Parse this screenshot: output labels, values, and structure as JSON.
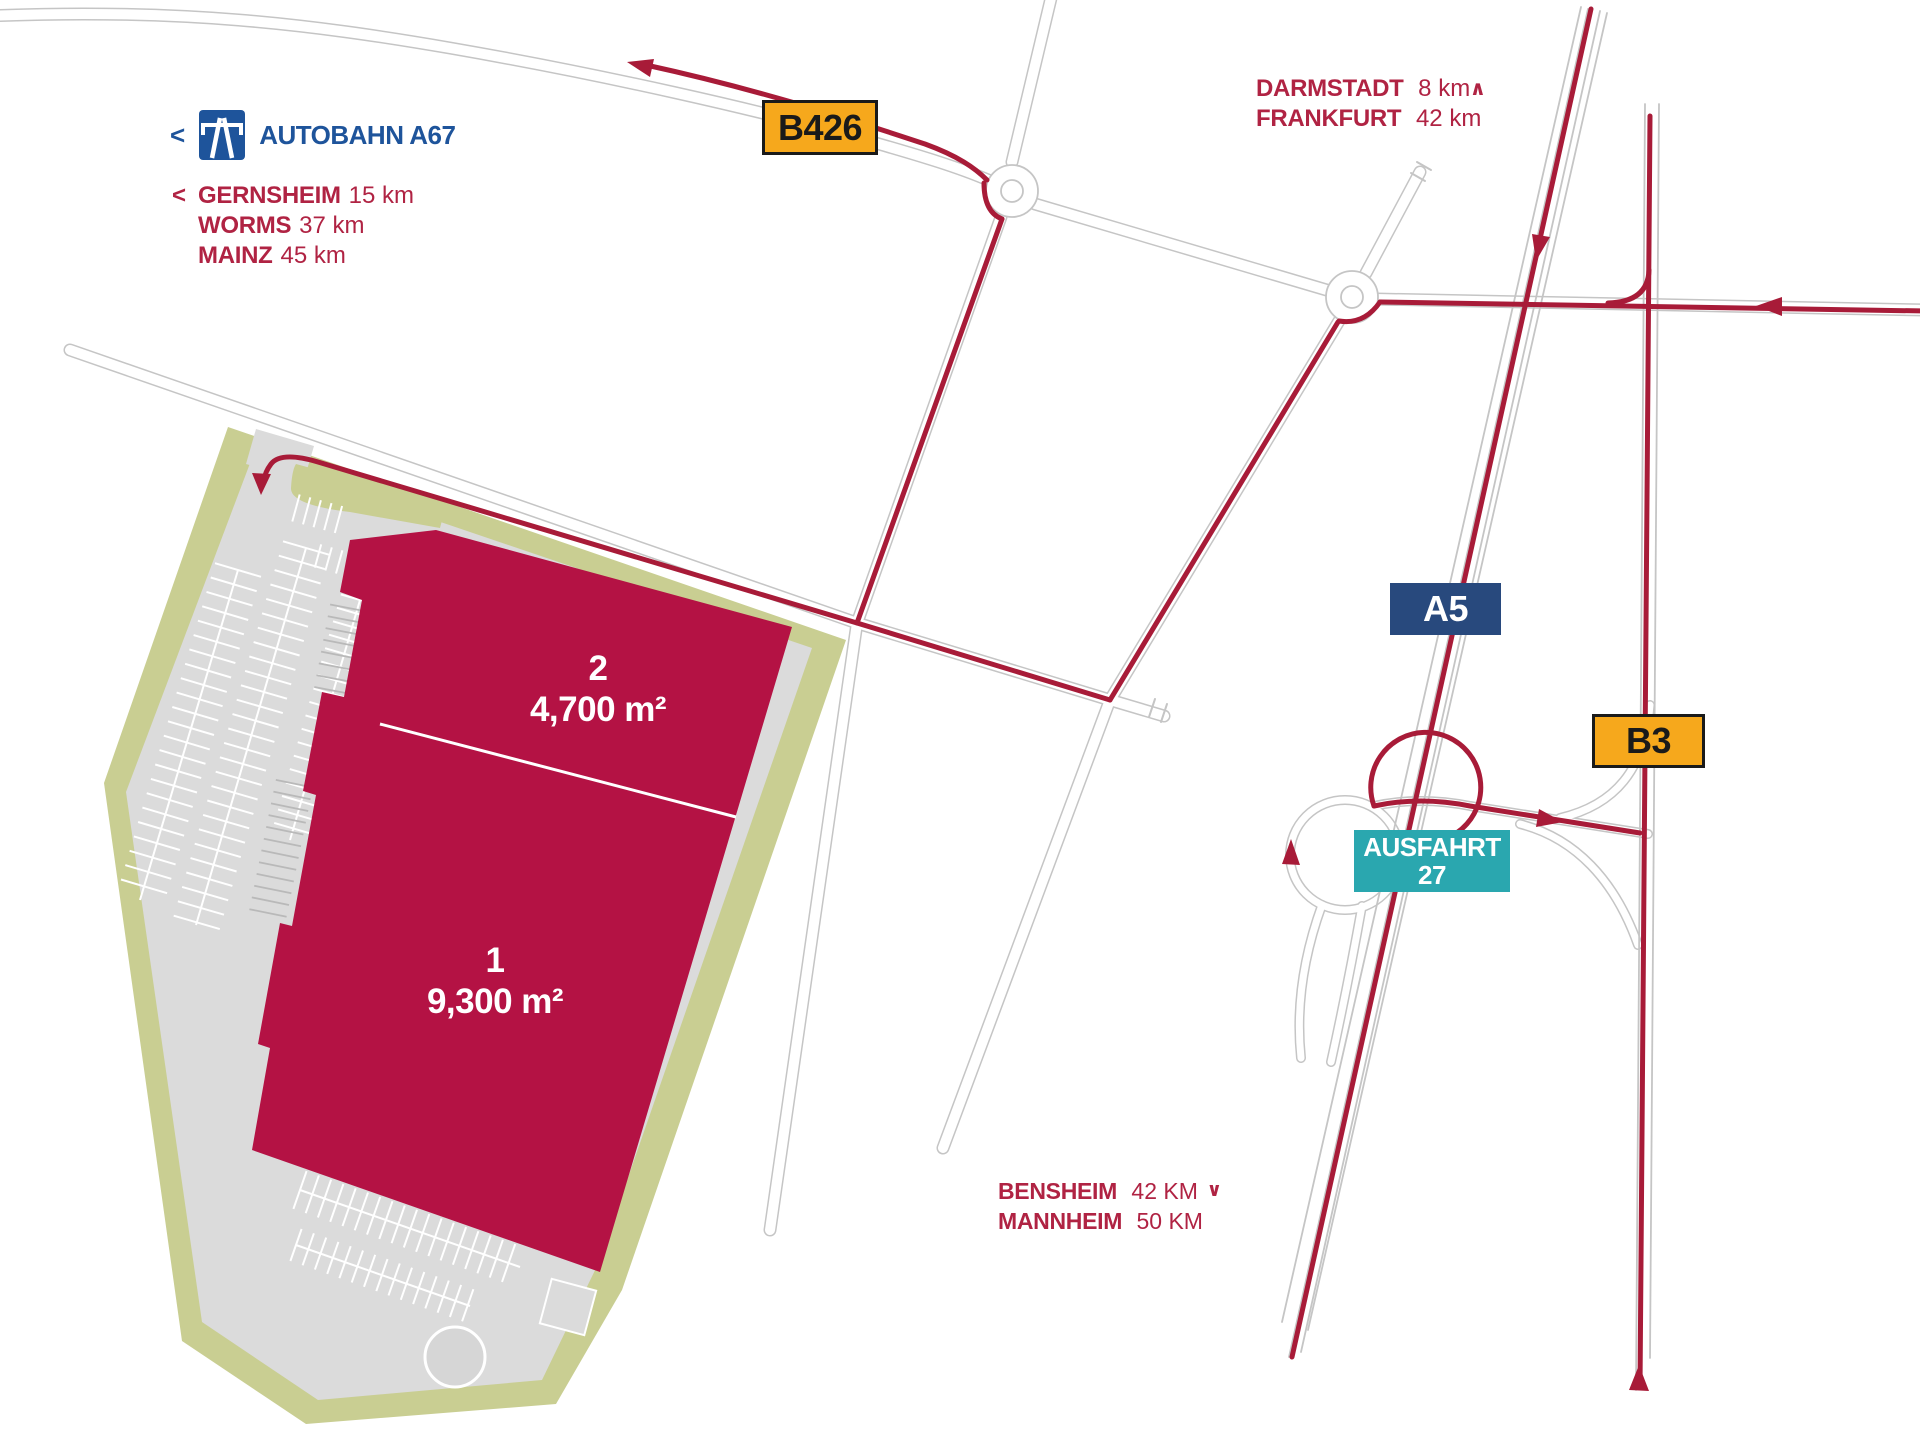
{
  "colors": {
    "brand_red": "#A81B38",
    "text_red": "#B02343",
    "building_red": "#B41244",
    "olive": "#C9CE92",
    "parking_grey": "#DBDBDB",
    "road_grey": "#C5C5C5",
    "autobahn_blue": "#1E549B",
    "a5_navy": "#28497D",
    "route_yellow": "#F6A81C",
    "exit_teal": "#2AA7AF"
  },
  "legend": {
    "autobahn": {
      "chevron": "<",
      "label": "AUTOBAHN A67"
    },
    "west": {
      "chevron": "<",
      "items": [
        {
          "city": "GERNSHEIM",
          "dist": "15 km"
        },
        {
          "city": "WORMS",
          "dist": "37 km"
        },
        {
          "city": "MAINZ",
          "dist": "45 km"
        }
      ]
    },
    "north": {
      "chevron": "∧",
      "items": [
        {
          "city": "DARMSTADT",
          "dist": "8 km"
        },
        {
          "city": "FRANKFURT",
          "dist": "42 km"
        }
      ]
    },
    "south": {
      "chevron": "∨",
      "items": [
        {
          "city": "BENSHEIM",
          "dist": "42 KM"
        },
        {
          "city": "MANNHEIM",
          "dist": "50 KM"
        }
      ]
    }
  },
  "badges": {
    "b426": "B426",
    "a5": "A5",
    "b3": "B3",
    "exit_line1": "AUSFAHRT",
    "exit_line2": "27"
  },
  "site": {
    "unit2": {
      "number": "2",
      "area": "4,700 m²"
    },
    "unit1": {
      "number": "1",
      "area": "9,300 m²"
    }
  }
}
